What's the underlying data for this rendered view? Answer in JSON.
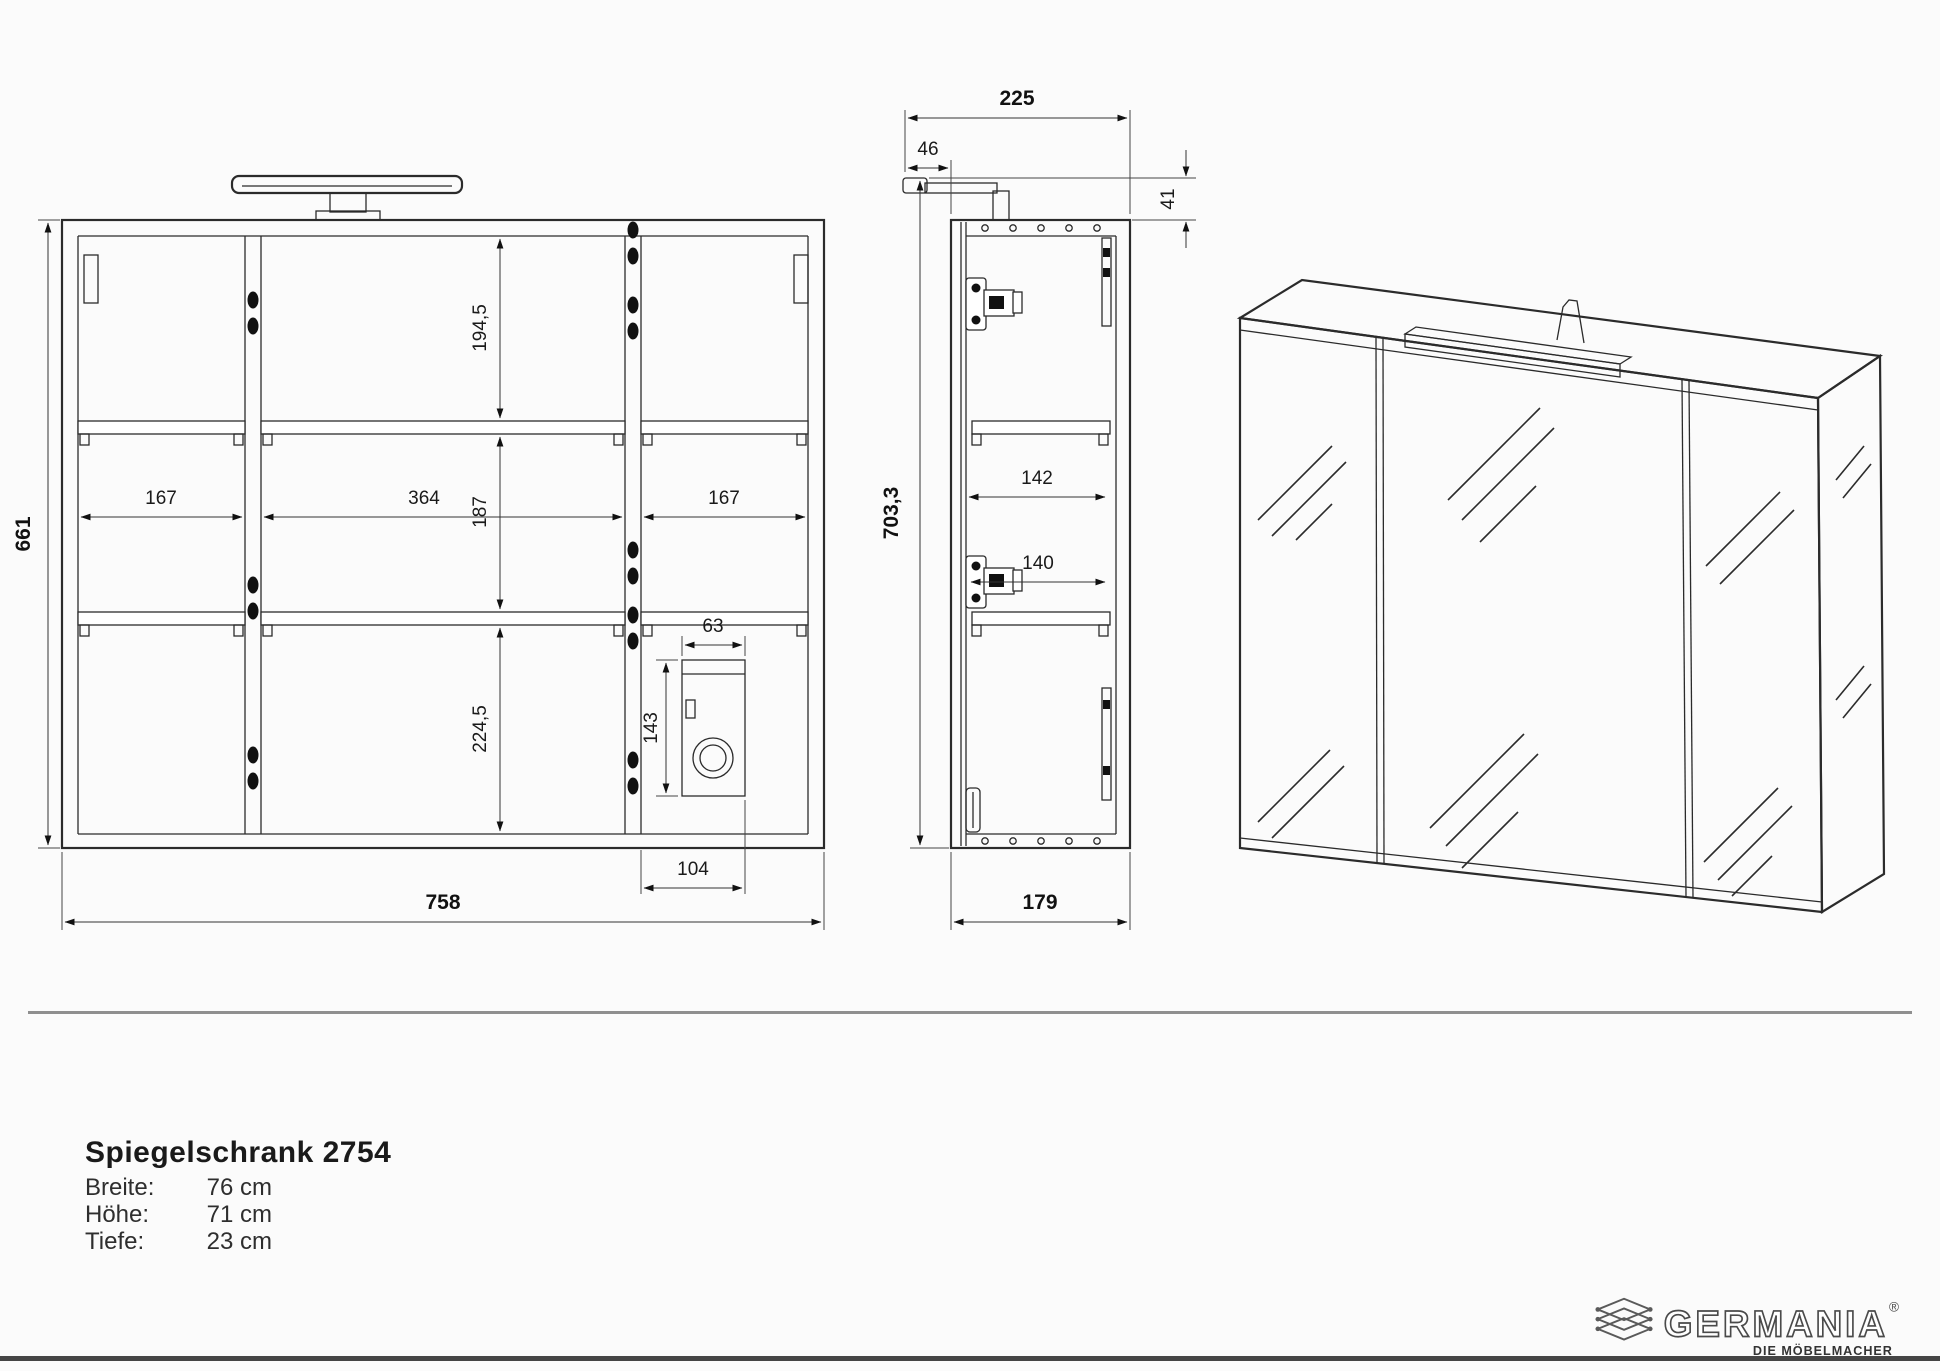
{
  "document": {
    "product_title": "Spiegelschrank 2754",
    "specs": [
      {
        "label": "Breite:",
        "value": "76 cm"
      },
      {
        "label": "Höhe:",
        "value": "71 cm"
      },
      {
        "label": "Tiefe:",
        "value": "23 cm"
      }
    ]
  },
  "front_view": {
    "dims": {
      "height": "661",
      "width": "758",
      "upper_section": "194,5",
      "middle_section": "187",
      "lower_section": "224,5",
      "left_compartment": "167",
      "center_compartment": "364",
      "right_compartment": "167",
      "socket_box_width": "63",
      "socket_box_height": "143",
      "socket_box_offset": "104"
    }
  },
  "side_view": {
    "dims": {
      "depth_with_light": "225",
      "light_overhang": "46",
      "light_height": "41",
      "height_with_light": "703,3",
      "clear_depth_upper": "142",
      "clear_depth_lower": "140",
      "depth": "179"
    }
  },
  "logo": {
    "brand": "GERMANIA",
    "registered": "®",
    "tagline": "DIE MÖBELMACHER"
  },
  "colors": {
    "ink": "#2b2b2b"
  }
}
